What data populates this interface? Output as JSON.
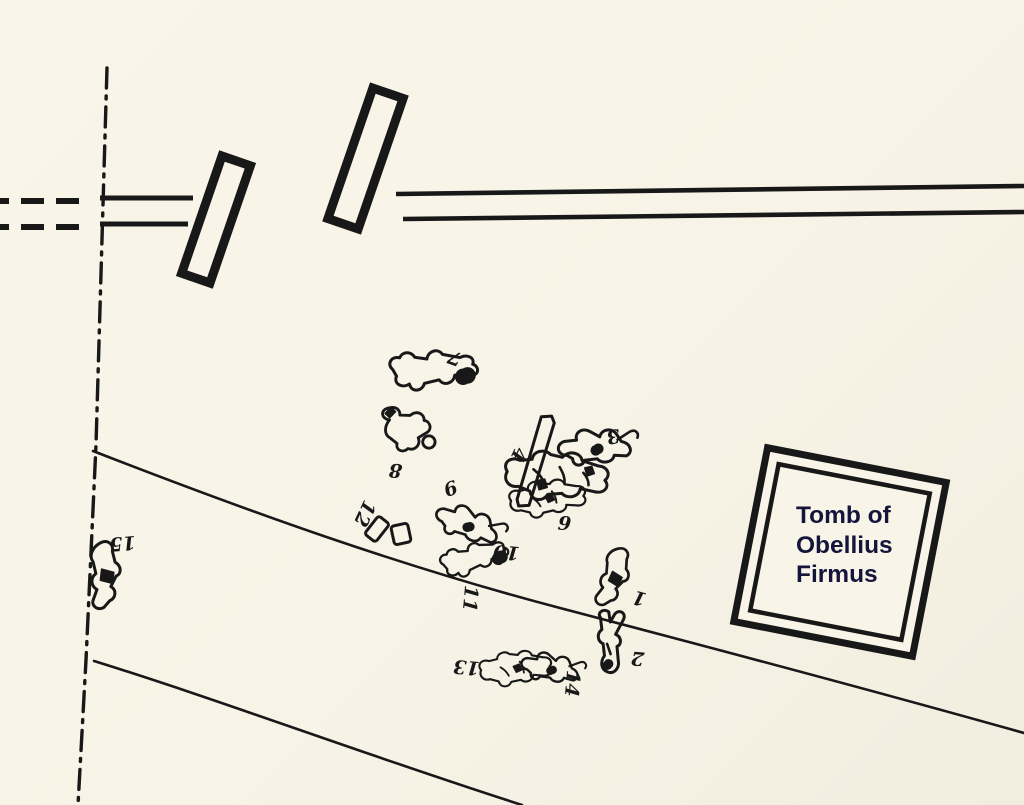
{
  "colors": {
    "background": "#f7f3e6",
    "ink": "#181818",
    "tomb_text": "#15153c"
  },
  "tomb": {
    "label": "Tomb of\nObellius\nFirmus"
  },
  "victims": [
    {
      "id": "1",
      "label": "1",
      "label_x": 641,
      "label_y": 592,
      "label_rot": 195,
      "shape": "crouch",
      "x": 613,
      "y": 577,
      "rot": 14,
      "scale": 0.9
    },
    {
      "id": "2",
      "label": "2",
      "label_x": 638,
      "label_y": 652,
      "label_rot": 185,
      "shape": "straightV",
      "x": 609,
      "y": 646,
      "rot": 3,
      "scale": 1.0
    },
    {
      "id": "3",
      "label": "3",
      "label_x": 612,
      "label_y": 430,
      "label_rot": 170,
      "shape": "runner",
      "x": 599,
      "y": 450,
      "rot": 12,
      "scale": 1.0
    },
    {
      "id": "4",
      "label": "4",
      "label_x": 513,
      "label_y": 452,
      "label_rot": 115,
      "shape": "tangleA",
      "x": 557,
      "y": 477,
      "rot": 4,
      "scale": 1.0
    },
    {
      "id": "6",
      "label": "6",
      "label_x": 453,
      "label_y": 495,
      "label_rot": -20,
      "shape": "runner",
      "x": 470,
      "y": 528,
      "rot": 35,
      "scale": 0.9
    },
    {
      "id": "7",
      "label": "7",
      "label_x": 457,
      "label_y": 352,
      "label_rot": 200,
      "shape": "sprawl",
      "x": 437,
      "y": 369,
      "rot": -6,
      "scale": 1.0
    },
    {
      "id": "8",
      "label": "8",
      "label_x": 396,
      "label_y": 464,
      "label_rot": 185,
      "shape": "curl",
      "x": 409,
      "y": 429,
      "rot": -20,
      "scale": 0.95
    },
    {
      "id": "9",
      "label": "9",
      "label_x": 564,
      "label_y": 530,
      "label_rot": 5,
      "shape": "tangleB",
      "x": 548,
      "y": 499,
      "rot": -5,
      "scale": 0.9
    },
    {
      "id": "10",
      "label": "10",
      "label_x": 507,
      "label_y": 546,
      "label_rot": 185,
      "shape": "sprawl",
      "x": 477,
      "y": 557,
      "rot": -18,
      "scale": 0.78
    },
    {
      "id": "11",
      "label": "11",
      "label_x": 464,
      "label_y": 598,
      "label_rot": 95,
      "shape": "none",
      "x": 0,
      "y": 0,
      "rot": 0,
      "scale": 1.0
    },
    {
      "id": "12",
      "label": "12",
      "label_x": 359,
      "label_y": 511,
      "label_rot": 115,
      "shape": "none",
      "x": 0,
      "y": 0,
      "rot": 0,
      "scale": 1.0
    },
    {
      "id": "13",
      "label": "13",
      "label_x": 467,
      "label_y": 661,
      "label_rot": 185,
      "shape": "tangleB",
      "x": 516,
      "y": 669,
      "rot": -4,
      "scale": 0.85
    },
    {
      "id": "14",
      "label": "14",
      "label_x": 566,
      "label_y": 683,
      "label_rot": 95,
      "shape": "runner",
      "x": 553,
      "y": 671,
      "rot": 25,
      "scale": 0.8
    },
    {
      "id": "15",
      "label": "15",
      "label_x": 122,
      "label_y": 537,
      "label_rot": 175,
      "shape": "crouch",
      "x": 104,
      "y": 575,
      "rot": -4,
      "scale": 1.0
    }
  ],
  "objects": [
    {
      "name": "plank-object",
      "shape": "plank",
      "x": 537,
      "y": 462,
      "rot": 13
    },
    {
      "name": "small-box-object-a",
      "shape": "boxA",
      "x": 377,
      "y": 529,
      "rot": 38
    },
    {
      "name": "small-box-object-b",
      "shape": "boxB",
      "x": 401,
      "y": 534,
      "rot": -12
    }
  ]
}
